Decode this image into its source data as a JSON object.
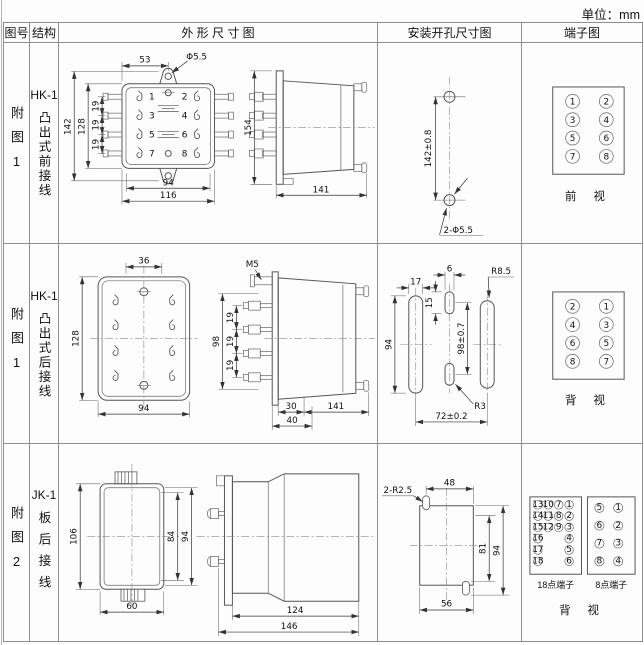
{
  "unit_label": "单位：mm",
  "header": {
    "figure": "图号",
    "structure": "结构",
    "outline": "外 形 尺 寸 图",
    "install": "安装开孔尺寸图",
    "terminal": "端子图"
  },
  "rows": [
    {
      "figure": "附图1",
      "model": "HK-1",
      "structure": "凸出式前接线",
      "outline": {
        "top_width": "53",
        "hole_dia": "Φ5.5",
        "height_outer": "142",
        "height_inner": "128",
        "pitch": [
          "19",
          "19",
          "19"
        ],
        "width_inner": "94",
        "width_outer": "116",
        "side_height": "154",
        "depth": "141",
        "pins": [
          "1",
          "2",
          "3",
          "4",
          "5",
          "6",
          "7",
          "8"
        ]
      },
      "install": {
        "hole_spacing": "142±0.8",
        "holes": "2-Φ5.5"
      },
      "terminal": {
        "left": [
          "1",
          "3",
          "5",
          "7"
        ],
        "right": [
          "2",
          "4",
          "6",
          "8"
        ],
        "view": "前 视"
      }
    },
    {
      "figure": "附图1",
      "model": "HK-1",
      "structure": "凸出式后接线",
      "outline": {
        "top_width": "36",
        "height": "128",
        "width": "94",
        "screw": "M5",
        "stud_span": "98",
        "pitch": [
          "19",
          "19",
          "19"
        ],
        "len_front": "30",
        "len_stud": "40",
        "depth": "141"
      },
      "install": {
        "slot_width": "17",
        "center_slot_width": "6",
        "center_slot_height": "15",
        "slot_height": "94",
        "center_spacing": "98±0.7",
        "hole_pitch": "72±0.2",
        "radius_outer": "R8.5",
        "radius_center": "R3"
      },
      "terminal": {
        "left": [
          "2",
          "4",
          "6",
          "8"
        ],
        "right": [
          "1",
          "3",
          "5",
          "7"
        ],
        "view": "背 视"
      }
    },
    {
      "figure": "附图2",
      "model": "JK-1",
      "structure": "板后接线",
      "outline": {
        "height": "106",
        "width": "60",
        "inner_height": "84",
        "flange_height": "94",
        "body_depth": "124",
        "total_depth": "146"
      },
      "install": {
        "corner_radius": "2-R2.5",
        "top_width": "48",
        "inner_height": "81",
        "outer_height": "94",
        "bottom_width": "56"
      },
      "terminal18": {
        "label": "18点端子",
        "col1": [
          "13",
          "14",
          "15",
          "16",
          "17",
          "18"
        ],
        "col2": [
          "10",
          "11",
          "12"
        ],
        "col3": [
          "7",
          "8",
          "9"
        ],
        "col4": [
          "1",
          "2",
          "3",
          "4",
          "5",
          "6"
        ]
      },
      "terminal8": {
        "label": "8点端子",
        "left": [
          "5",
          "6",
          "7",
          "8"
        ],
        "right": [
          "1",
          "2",
          "3",
          "4"
        ]
      },
      "view": "背 视"
    }
  ]
}
